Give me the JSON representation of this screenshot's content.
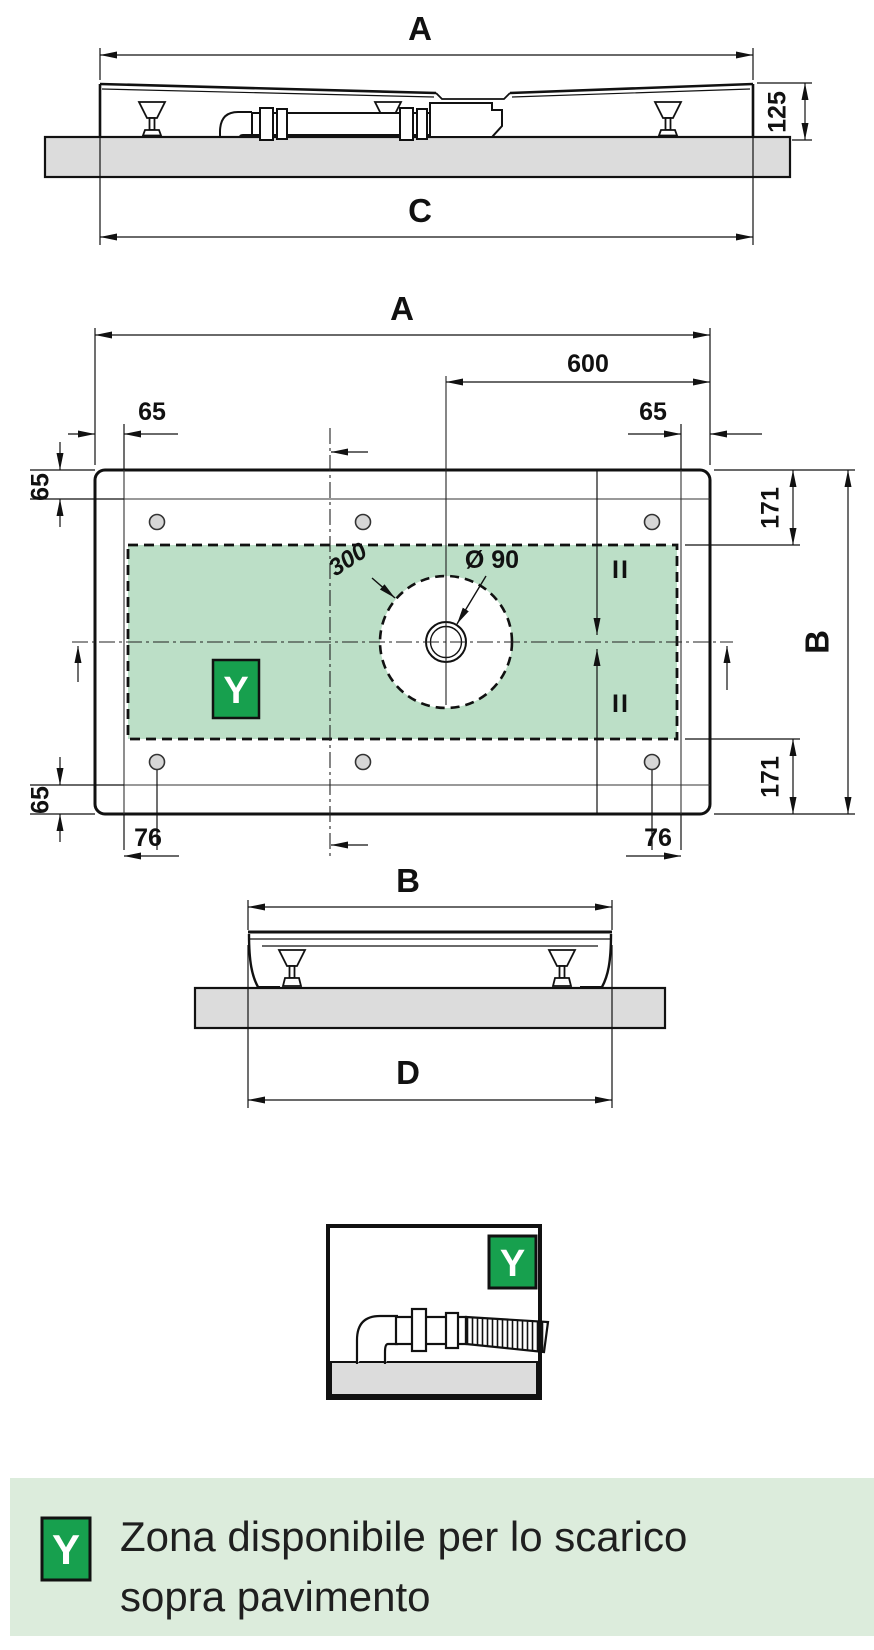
{
  "labels": {
    "dim_A": "A",
    "dim_B": "B",
    "dim_C": "C",
    "dim_D": "D",
    "dim_125": "125",
    "dim_600": "600",
    "dim_65": "65",
    "dim_171": "171",
    "dim_76": "76",
    "dim_300": "300",
    "dim_diameter_90": "Ø 90",
    "equal_mark": "II",
    "zone_letter": "Y"
  },
  "legend": {
    "symbol": "Y",
    "line1": "Zona disponibile per lo scarico",
    "line2": "sopra pavimento"
  },
  "colors": {
    "zone_green": "#bcdfc7",
    "badge_green": "#17a04e",
    "legend_bg": "#dcecdc",
    "floor_gray": "#dcdcdc",
    "line": "#111111"
  }
}
